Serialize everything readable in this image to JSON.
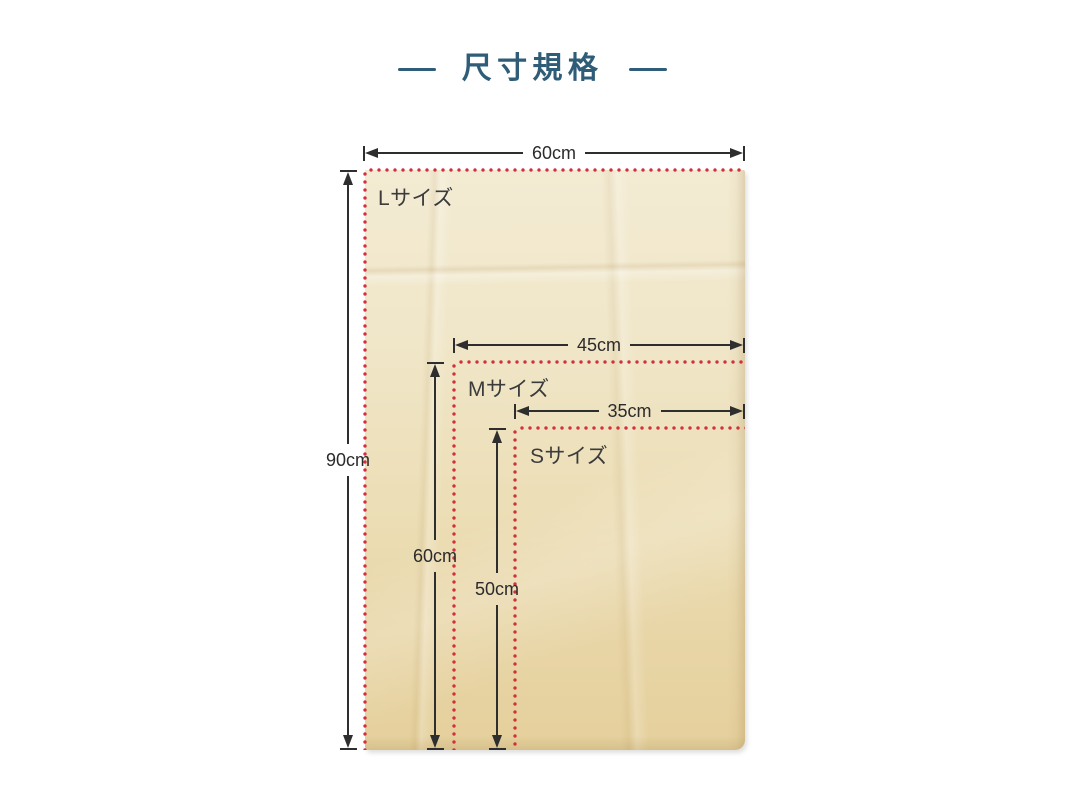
{
  "title": {
    "text": "尺寸規格"
  },
  "diagram": {
    "sizes": [
      {
        "name": "L",
        "label": "Lサイズ",
        "width": "60cm",
        "height": "90cm"
      },
      {
        "name": "M",
        "label": "Mサイズ",
        "width": "45cm",
        "height": "60cm"
      },
      {
        "name": "S",
        "label": "Sサイズ",
        "width": "35cm",
        "height": "50cm"
      }
    ],
    "colors": {
      "outline_dots": "#d3303e",
      "dimension_lines": "#2e2e2e",
      "label_text": "#3b3b3b",
      "bag_fill": "#eee3c2",
      "title": "#2f5d78"
    }
  }
}
